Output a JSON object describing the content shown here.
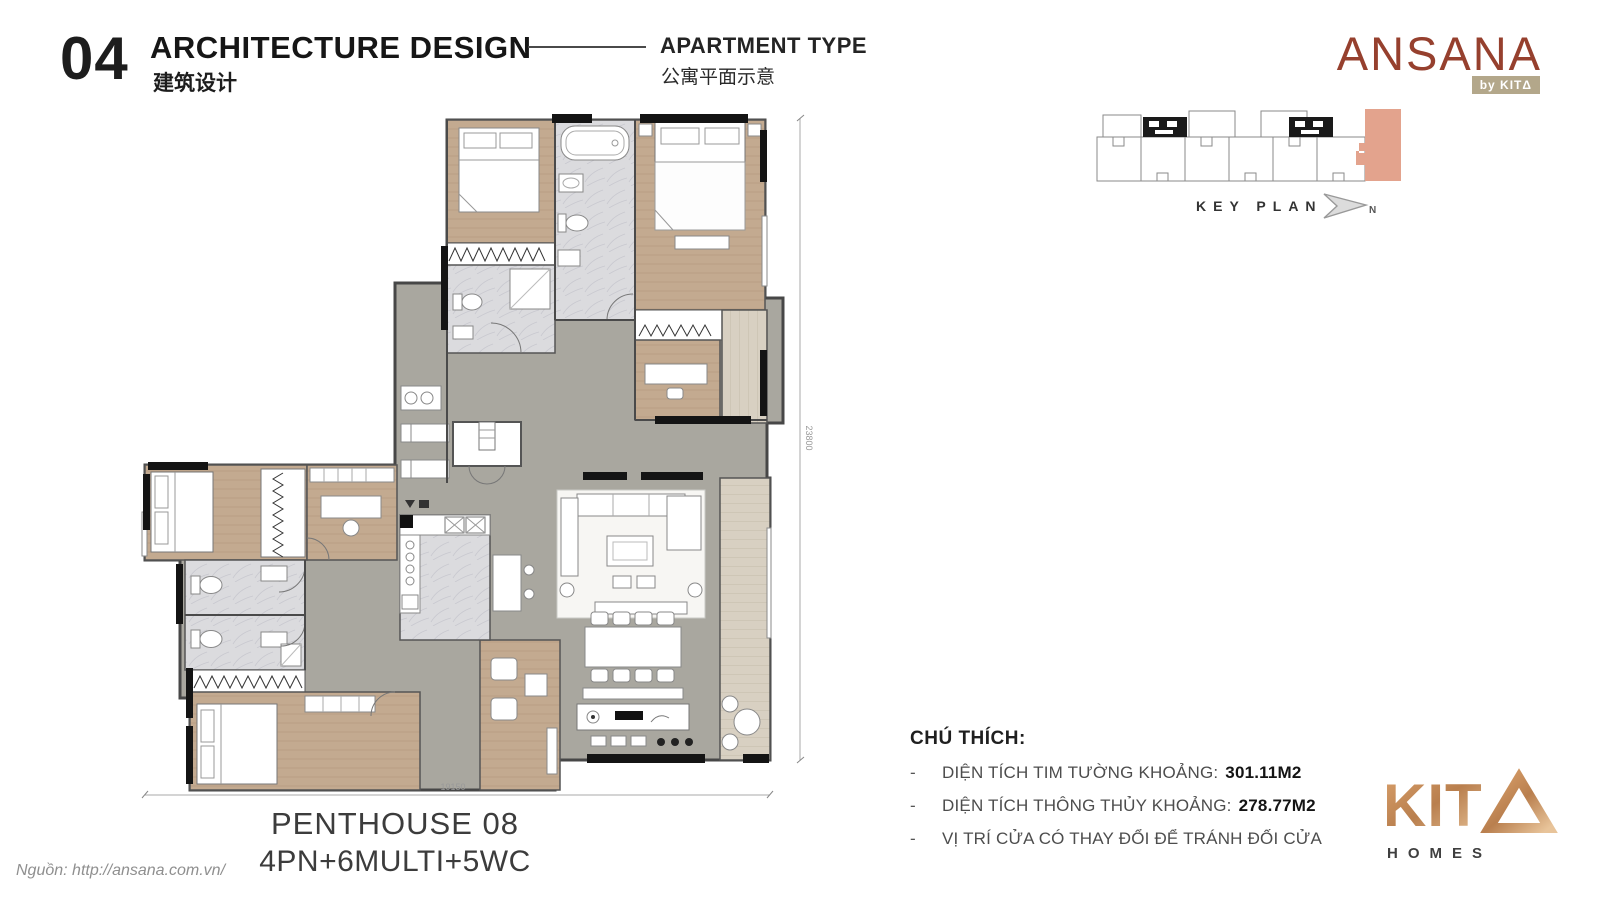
{
  "header": {
    "section_number": "04",
    "title": "ARCHITECTURE DESIGN",
    "title_cn": "建筑设计",
    "subtitle": "APARTMENT TYPE",
    "subtitle_cn": "公寓平面示意"
  },
  "brand": {
    "name": "ANSANA",
    "byline": "by KITΔ",
    "logo_color": "#96402e"
  },
  "key_plan": {
    "label": "KEY PLAN",
    "north": "N",
    "highlight_color": "#e3a38d"
  },
  "plan": {
    "title": "PENTHOUSE 08",
    "program": "4PN+6MULTI+5WC",
    "dim_width": "19150",
    "dim_height": "23800"
  },
  "legend": {
    "title": "CHÚ THÍCH:",
    "bullet": "-",
    "items": [
      {
        "label": "DIỆN TÍCH TIM TƯỜNG KHOẢNG:",
        "value": "301.11M2"
      },
      {
        "label": "DIỆN TÍCH THÔNG THỦY KHOẢNG:",
        "value": "278.77M2"
      },
      {
        "label": "VỊ TRÍ CỬA CÓ THAY ĐỔI ĐỂ TRÁNH ĐỐI CỬA",
        "value": ""
      }
    ]
  },
  "source": {
    "text": "Nguồn: http://ansana.com.vn/"
  },
  "kita": {
    "wordmark": "KIT",
    "homes": "HOMES"
  }
}
